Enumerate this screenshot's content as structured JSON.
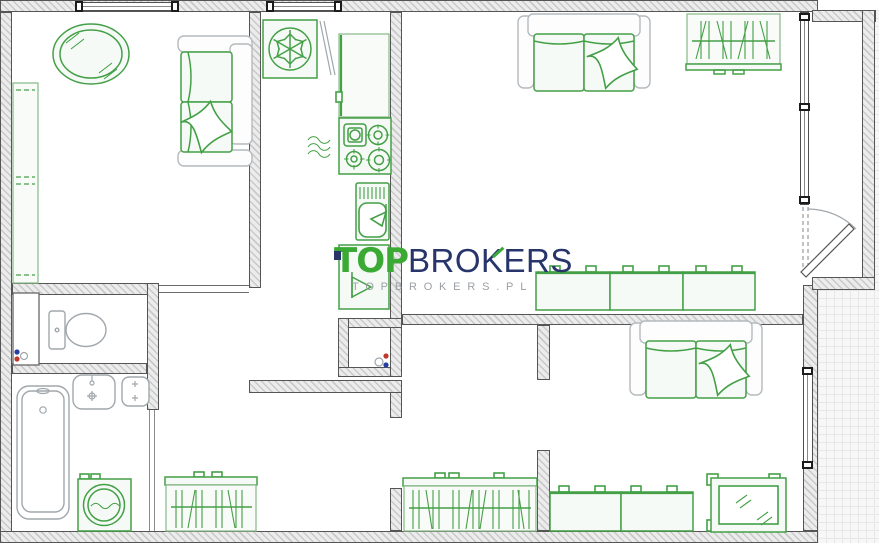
{
  "watermark": {
    "brand_primary": "TOP",
    "brand_pre": "BRO",
    "brand_k": "K",
    "brand_post": "ERS",
    "tagline": "TOPBROKERS.PL"
  },
  "colors": {
    "furniture_green": "#44a047",
    "furniture_light": "#8fbc8f",
    "fixture_gray": "#a0a7ac",
    "wall_line": "#555555",
    "logo_green": "#3aaa35",
    "logo_navy": "#27356b",
    "tagline_gray": "#9aa0a5",
    "riser_red": "#c1392d",
    "riser_blue": "#243fa0"
  },
  "symbols": [
    "oval-table",
    "sofa-with-pillow",
    "tall-wardrobe",
    "window",
    "fridge-snowflake",
    "kitchen-counter",
    "stove-four-burners",
    "steam-waves",
    "kitchen-sink",
    "sink-cabinet-tap",
    "hanger-wardrobe",
    "cabinet-row",
    "mirror-frame",
    "toilet",
    "washbasin",
    "niche-sink",
    "bathtub",
    "washing-machine",
    "pipe-riser-dots",
    "balcony-door-arc",
    "balcony-tiles"
  ]
}
